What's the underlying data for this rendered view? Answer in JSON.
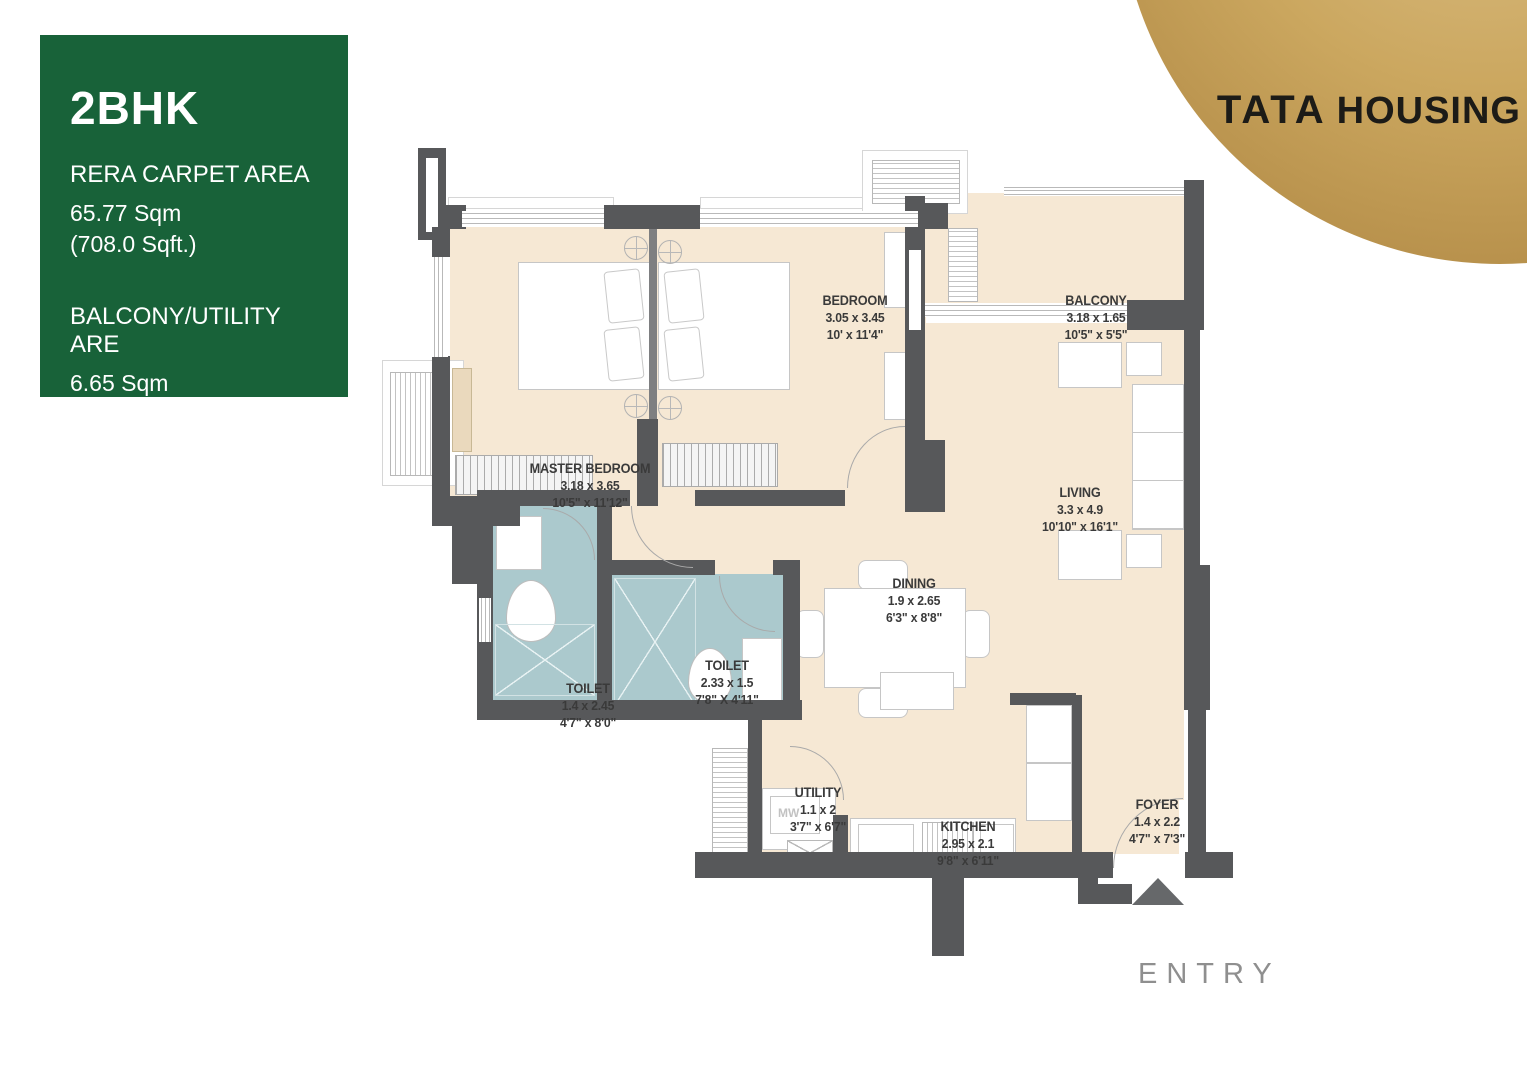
{
  "info_panel": {
    "title": "2BHK",
    "carpet_label": "RERA CARPET AREA",
    "carpet_sqm": "65.77 Sqm",
    "carpet_sqft": "(708.0 Sqft.)",
    "balcony_label": "BALCONY/UTILITY ARE",
    "balcony_sqm": "6.65 Sqm",
    "balcony_sqft": "(72.0 Sqft.)",
    "bg_color": "#186239"
  },
  "brand": {
    "name_primary": "TATA",
    "name_secondary": "HOUSING",
    "gold_color": "#cba75f"
  },
  "rooms": [
    {
      "id": "master-bedroom",
      "name": "MASTER BEDROOM",
      "dim_m": "3.18 x 3.65",
      "dim_ft": "10'5\" x 11'12\""
    },
    {
      "id": "bedroom",
      "name": "BEDROOM",
      "dim_m": "3.05 x 3.45",
      "dim_ft": "10' x 11'4\""
    },
    {
      "id": "balcony",
      "name": "BALCONY",
      "dim_m": "3.18 x 1.65",
      "dim_ft": "10'5\" x 5'5\""
    },
    {
      "id": "living",
      "name": "LIVING",
      "dim_m": "3.3 x 4.9",
      "dim_ft": "10'10\" x 16'1\""
    },
    {
      "id": "dining",
      "name": "DINING",
      "dim_m": "1.9 x 2.65",
      "dim_ft": "6'3\" x 8'8\""
    },
    {
      "id": "toilet-1",
      "name": "TOILET",
      "dim_m": "1.4 x 2.45",
      "dim_ft": "4'7\" x 8'0\""
    },
    {
      "id": "toilet-2",
      "name": "TOILET",
      "dim_m": "2.33 x 1.5",
      "dim_ft": "7'8\" X 4'11\""
    },
    {
      "id": "utility",
      "name": "UTILITY",
      "dim_m": "1.1 x 2",
      "dim_ft": "3'7\" x 6'7\""
    },
    {
      "id": "kitchen",
      "name": "KITCHEN",
      "dim_m": "2.95 x 2.1",
      "dim_ft": "9'8\" x 6'11\""
    },
    {
      "id": "foyer",
      "name": "FOYER",
      "dim_m": "1.4 x 2.2",
      "dim_ft": "4'7\" x 7'3\""
    }
  ],
  "entry_label": "ENTRY",
  "appliance_labels": {
    "microwave": "MW"
  },
  "colors": {
    "wall": "#57585a",
    "floor": "#f6e8d4",
    "toilet_floor": "#abc9cd",
    "accent_green": "#186239",
    "brand_gold": "#cba75f"
  }
}
